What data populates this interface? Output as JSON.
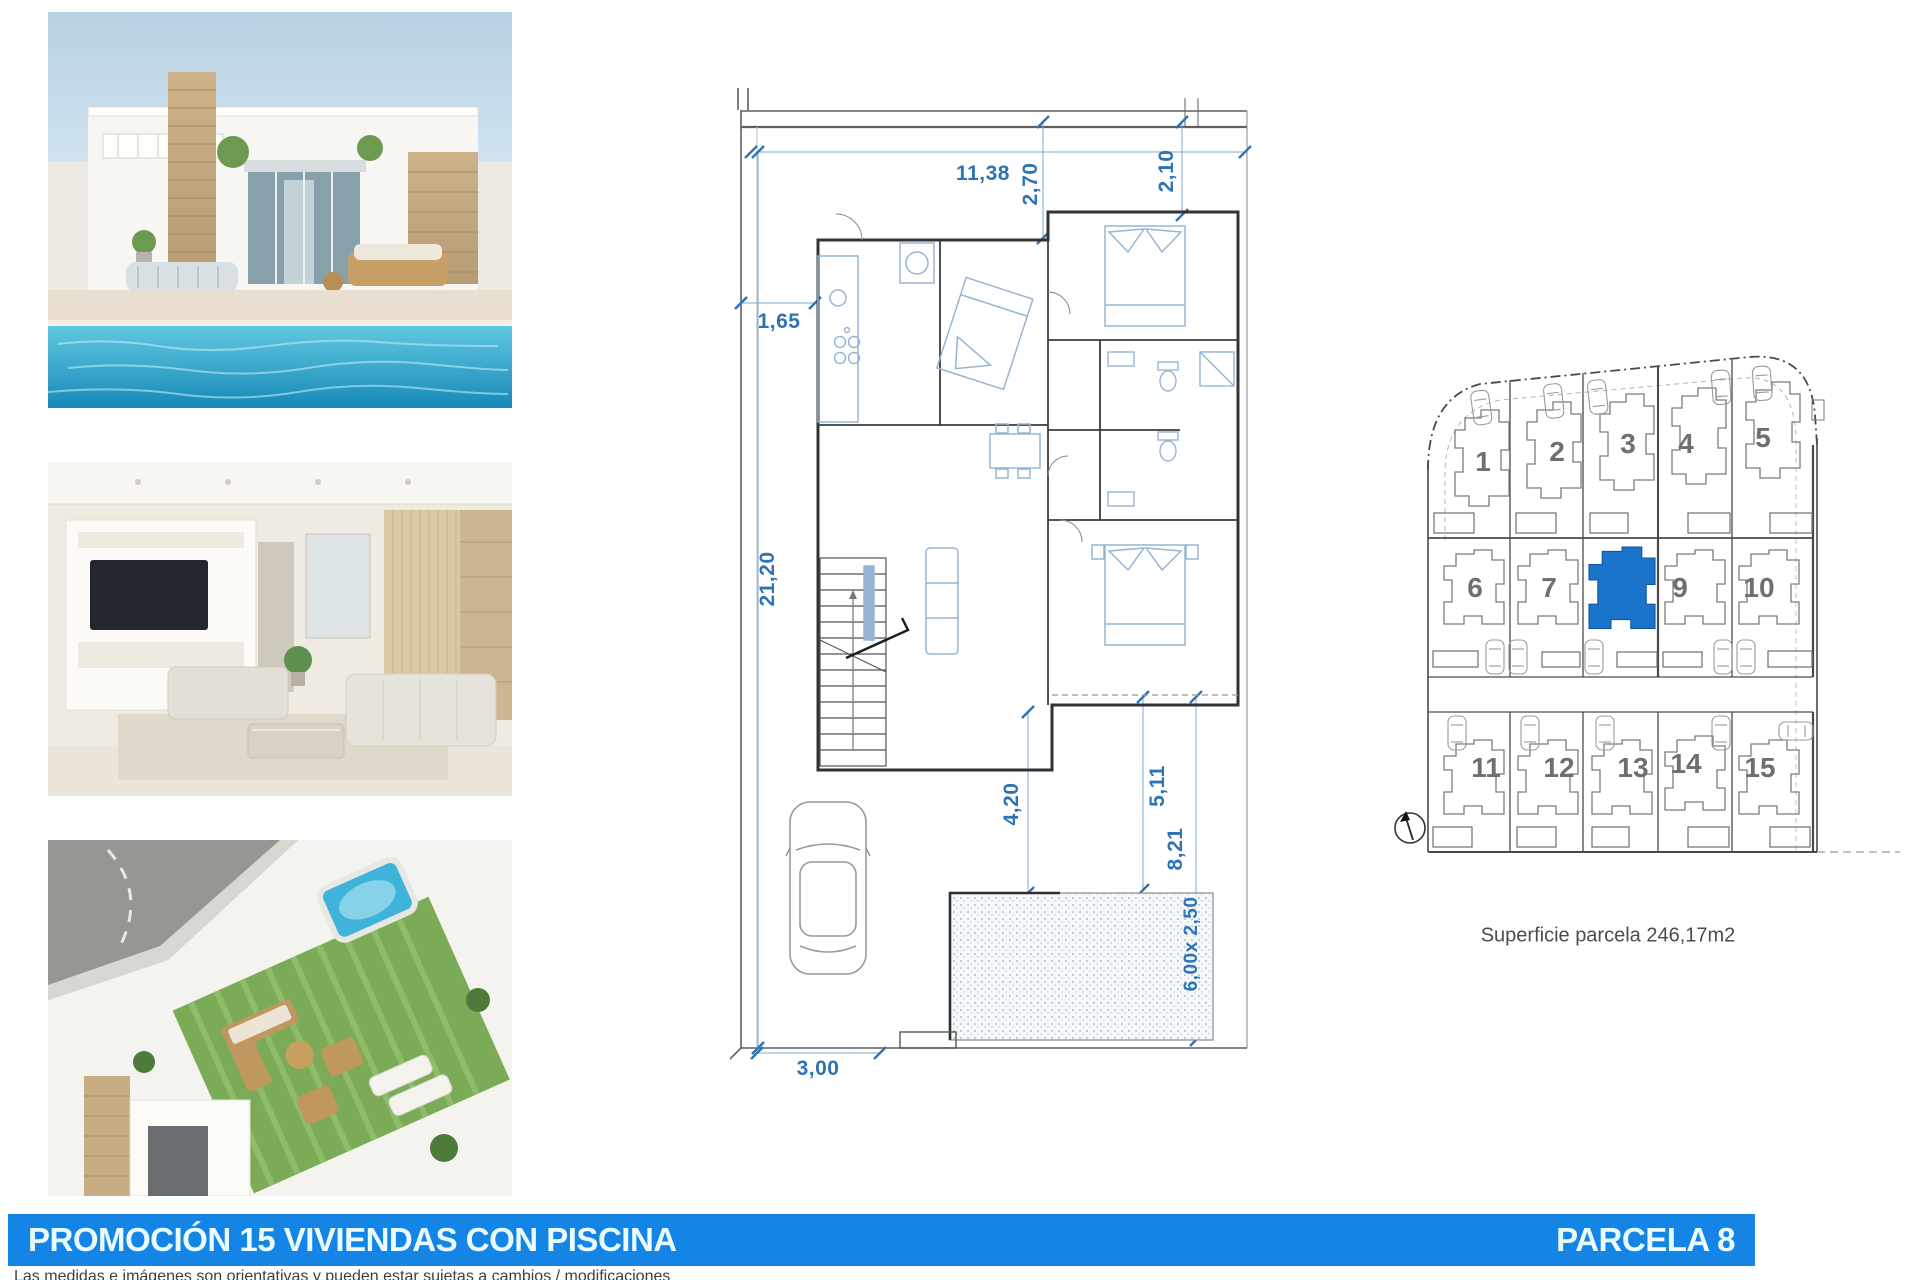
{
  "banner": {
    "title": "PROMOCIÓN 15 VIVIENDAS CON PISCINA",
    "parcel_label": "PARCELA 8",
    "bg_color": "#1585e5",
    "text_color": "#e9fbff"
  },
  "disclaimer": "Las medidas e imágenes son orientativas y pueden estar sujetas a cambios / modificaciones",
  "photos": {
    "top": "villa-exterior-with-private-pool",
    "middle": "living-room-interior-render",
    "bottom": "rooftop-terrace-aerial-render"
  },
  "floor_plan": {
    "dim_color": "#2e74b5",
    "dims": {
      "top_width": "11,38",
      "top_depth_a": "2,70",
      "top_depth_b": "2,10",
      "side_offset": "1,65",
      "lot_depth": "21,20",
      "terrace_to_pool": "4,20",
      "pool_dist_a": "5,11",
      "pool_dist_b": "8,21",
      "pool_size": "6,00x 2,50",
      "drive_width": "3,00"
    }
  },
  "site_plan": {
    "rows": [
      [
        "1",
        "2",
        "3",
        "4",
        "5"
      ],
      [
        "6",
        "7",
        "9",
        "10"
      ],
      [
        "11",
        "12",
        "13",
        "14",
        "15"
      ]
    ],
    "highlighted_parcel": "8",
    "highlight_color": "#1b74cc",
    "caption": "Superficie parcela 246,17m2"
  }
}
